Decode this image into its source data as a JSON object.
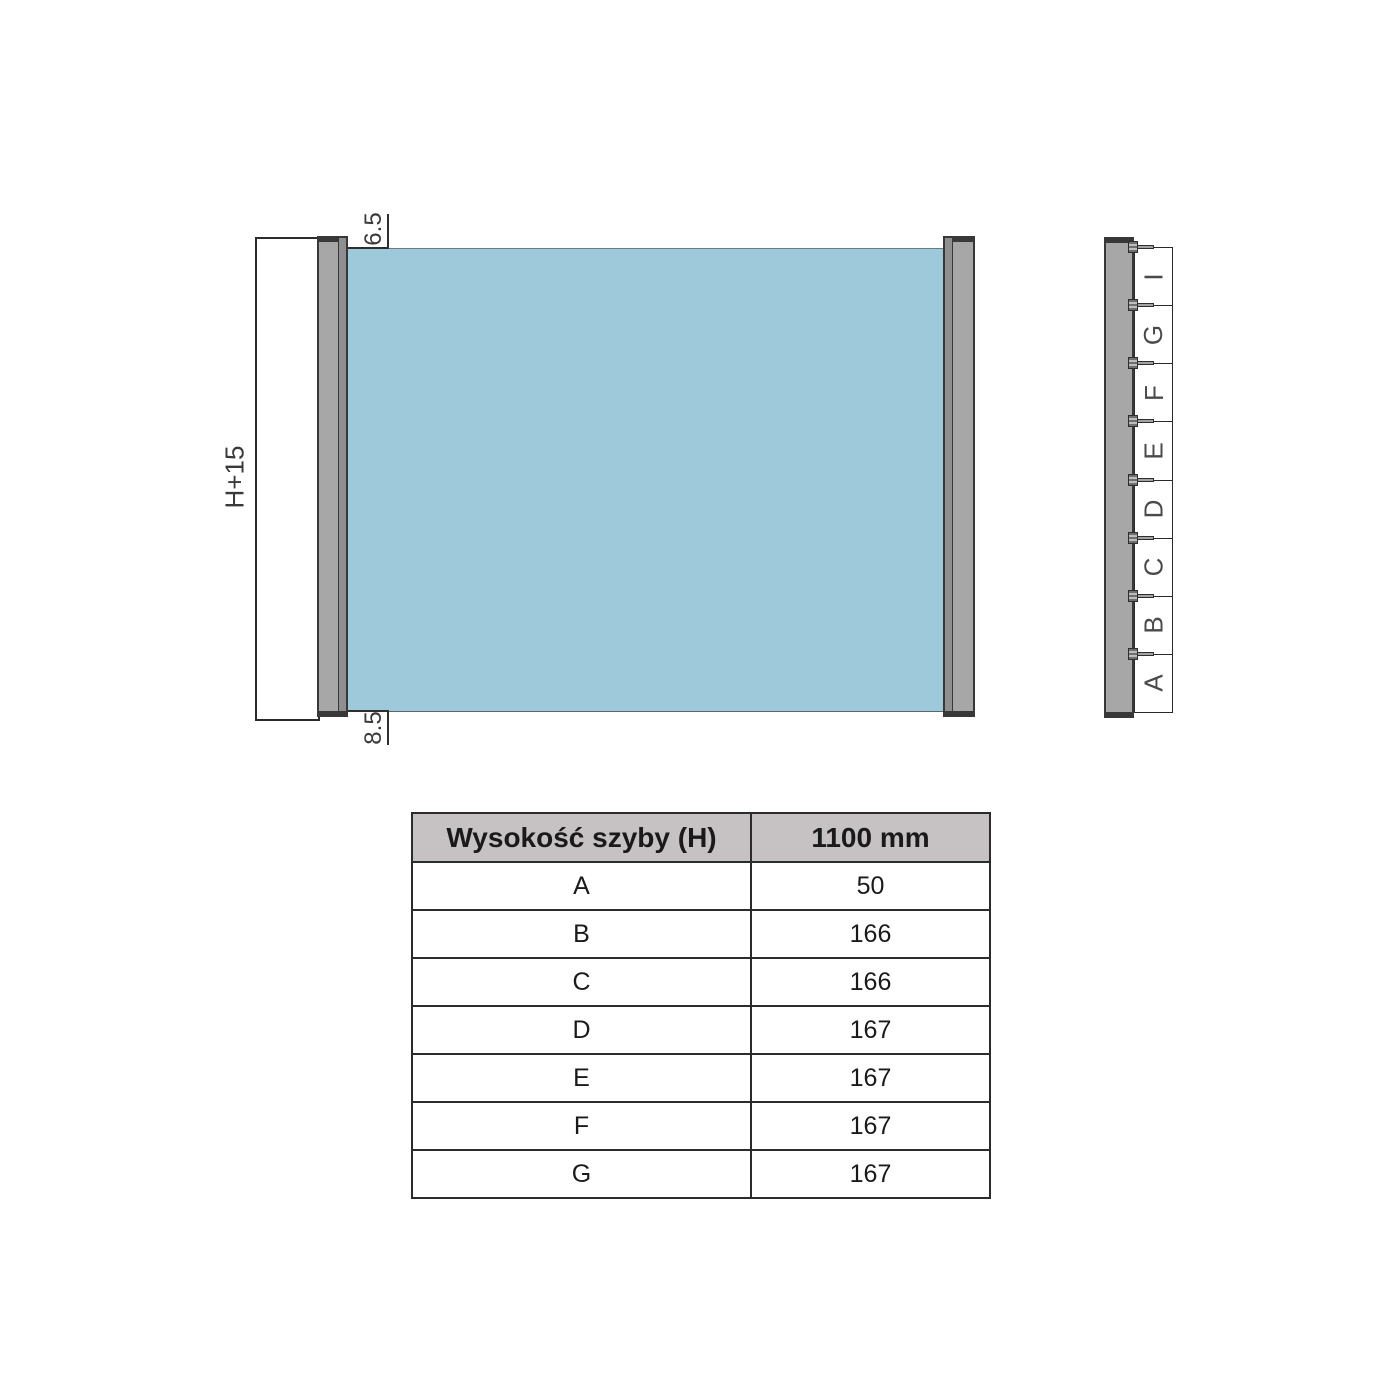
{
  "front_view": {
    "height_dim": "H+15",
    "top_gap_dim": "6.5",
    "bottom_gap_dim": "8.5"
  },
  "side_view": {
    "segments_top_to_bottom": [
      "I",
      "G",
      "F",
      "E",
      "D",
      "C",
      "B",
      "A"
    ]
  },
  "table": {
    "headers": [
      "Wysokość szyby (H)",
      "1100 mm"
    ],
    "rows": [
      {
        "label": "A",
        "value": "50"
      },
      {
        "label": "B",
        "value": "166"
      },
      {
        "label": "C",
        "value": "166"
      },
      {
        "label": "D",
        "value": "167"
      },
      {
        "label": "E",
        "value": "167"
      },
      {
        "label": "F",
        "value": "167"
      },
      {
        "label": "G",
        "value": "167"
      }
    ]
  },
  "colors": {
    "glass": "#9dc9db",
    "profile": "#a7a7a7",
    "profile_dark": "#383838",
    "table_header_bg": "#c6c2c4"
  }
}
